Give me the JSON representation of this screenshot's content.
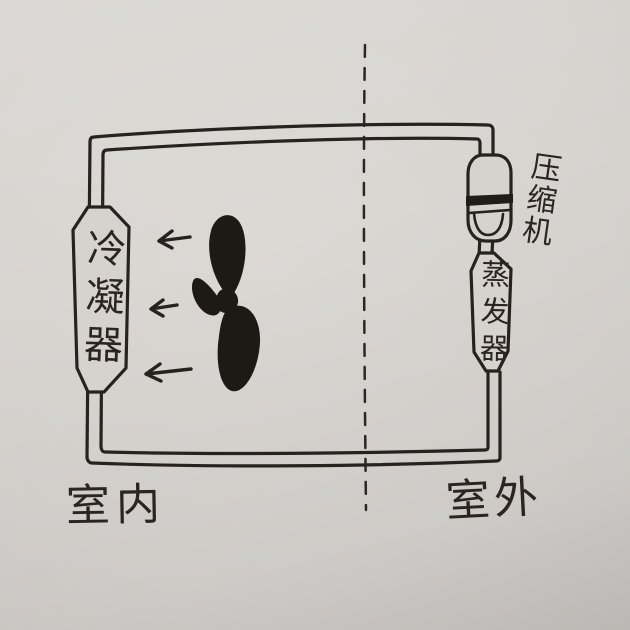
{
  "diagram": {
    "kind": "hand-drawn refrigeration cycle sketch on paper",
    "colors": {
      "paper": "#d6d3cf",
      "ink": "#26221d"
    },
    "zones": {
      "indoor": {
        "label": "室内",
        "side": "left of dashed divider"
      },
      "outdoor": {
        "label": "室外",
        "side": "right of dashed divider"
      }
    },
    "components": {
      "condenser": {
        "label": "冷凝器",
        "location": "left pipe segment, indoor side"
      },
      "compressor": {
        "label": "压缩机",
        "location": "top of right pipe segment, outdoor side"
      },
      "evaporator": {
        "label": "蒸发器",
        "location": "right pipe segment below compressor, outdoor side"
      }
    },
    "icons": {
      "fan": "four-blade ink-filled propeller fan",
      "airflow_arrow": {
        "glyph": "←",
        "count": 3,
        "direction": "left, blowing from fan toward condenser"
      },
      "divider": "vertical dashed line separating indoor and outdoor"
    }
  }
}
